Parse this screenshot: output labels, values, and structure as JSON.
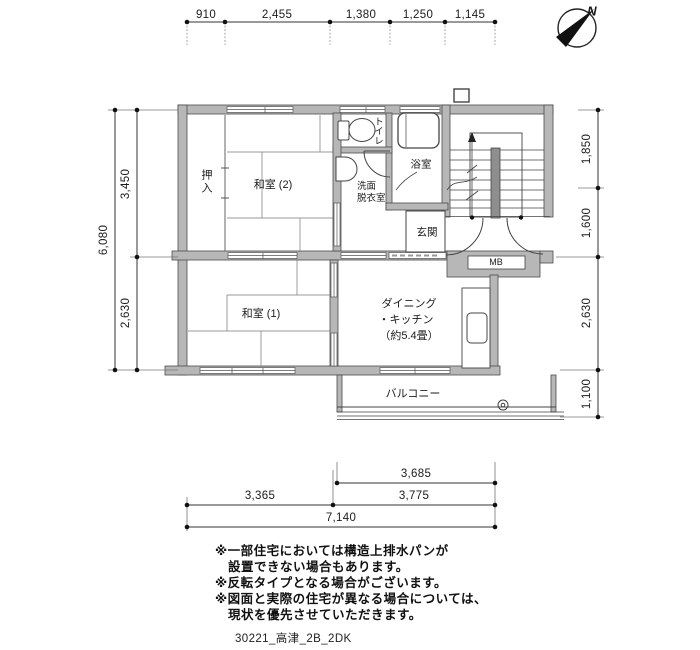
{
  "title": "apartment floor plan",
  "compass": {
    "north": "N"
  },
  "colors": {
    "wall_fill": "#b7b7b7",
    "line": "#3a3a3a",
    "rail_fill": "#8e8e8e"
  },
  "dims": {
    "top": [
      "910",
      "2,455",
      "1,380",
      "1,250",
      "1,145"
    ],
    "left_total": "6,080",
    "left": [
      "3,450",
      "2,630"
    ],
    "right": [
      "1,850",
      "1,600",
      "2,630",
      "1,100"
    ],
    "bottom": {
      "upper": "3,685",
      "mid": [
        "3,365",
        "3,775"
      ],
      "total": "7,140"
    }
  },
  "rooms": {
    "closet": "押入",
    "washitsu2": "和室 (2)",
    "toilet": "トイレ",
    "washroom1": "洗面",
    "washroom2": "脱衣室",
    "bath": "浴室",
    "entrance": "玄関",
    "mb": "MB",
    "washitsu1": "和室 (1)",
    "dk1": "ダイニング",
    "dk2": "・キッチン",
    "dk3": "（約5.4畳）",
    "balcony": "バルコニー"
  },
  "notes": [
    "※一部住宅においては構造上排水パンが",
    "　設置できない場合もあります。",
    "※反転タイプとなる場合がございます。",
    "※図面と実際の住宅が異なる場合については、",
    "　現状を優先させていただきます。"
  ],
  "footer": "30221_高津_2B_2DK"
}
